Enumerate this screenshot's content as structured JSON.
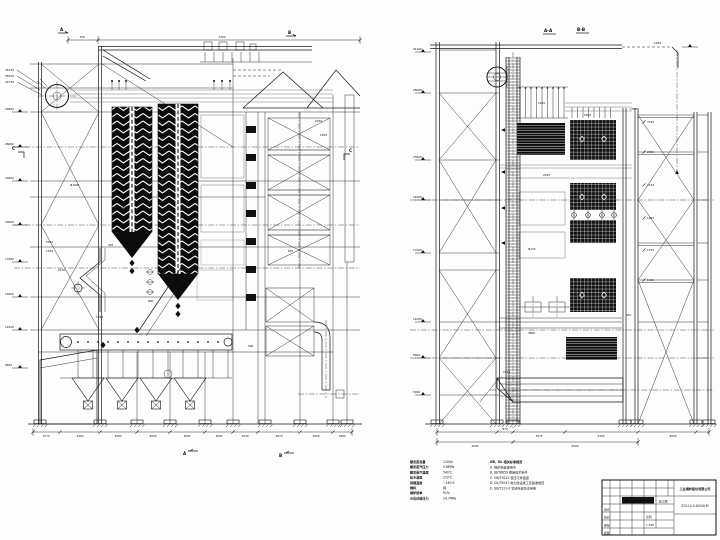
{
  "left_view": {
    "section_a": "A",
    "section_b": "B",
    "section_c_left": "C",
    "section_c_right": "C",
    "bottom_section_a": "A",
    "bottom_section_b": "B",
    "top_dims": [
      "750",
      "7200"
    ],
    "drum_callouts": [
      "36330",
      "35500",
      "34730"
    ],
    "left_elevations": [
      "29600",
      "26600",
      "23600",
      "20600",
      "17600",
      "14600",
      "11600",
      "8600"
    ],
    "bottom_dims": [
      "1570",
      "2400",
      "3000",
      "3000",
      "3000",
      "3000",
      "2540",
      "3070",
      "3000",
      "1800"
    ],
    "inner_dims": [
      "345",
      "2640",
      "1430",
      "16-Φ426",
      "Φ1600",
      "2740",
      "1959",
      "800",
      "2430",
      "1250",
      "500",
      "645"
    ]
  },
  "right_view": {
    "label_aa": "A-A",
    "label_bb": "B-B",
    "top_dim": "1959",
    "left_elevations": [
      "31100",
      "28000",
      "23600",
      "21000",
      "17000",
      "11000",
      "8000",
      "5000"
    ],
    "right_dims": [
      "7150",
      "2450",
      "2143",
      "1950",
      "1750",
      "1310"
    ],
    "bottom_dims_upper": [
      "870",
      "3075",
      "5300",
      "4000"
    ],
    "bottom_dims_lower": [
      "4500",
      "5000"
    ],
    "inner_dims": [
      "1250",
      "2420",
      "Φ133",
      "2500",
      "3600",
      "970",
      "2130",
      "1350"
    ]
  },
  "notes": {
    "specs": [
      {
        "label": "额定蒸发量",
        "value": "110t/h"
      },
      {
        "label": "额定蒸汽压力",
        "value": "9.8MPa"
      },
      {
        "label": "额定蒸汽温度",
        "value": "540℃"
      },
      {
        "label": "给水温度",
        "value": "210℃"
      },
      {
        "label": "排烟温度",
        "value": "~140℃"
      },
      {
        "label": "燃料",
        "value": "煤"
      },
      {
        "label": "锅炉效率",
        "value": "91%"
      },
      {
        "label": "水压试验压力",
        "value": "14.7MPa"
      }
    ],
    "standards_header": "GB、DL 相关标准规范",
    "standards": [
      "A. 锅炉安装说明书",
      "B. JB/T8659 焊接技术条件",
      "C. GB/T9222 受压元件强度",
      "D. DL/T5047 电力建设施工及验收规范",
      "E. GB/T121-0 管道布置及支吊架"
    ]
  },
  "title_block": {
    "company": "工业锅炉股份有限公司",
    "drawing_no": "ZG110-9.8/540-M",
    "title": "锅炉总图",
    "stage": "施工图",
    "scale_label": "比例",
    "scale": "1:100",
    "sig_labels": [
      "设计",
      "校对",
      "审核",
      "批准"
    ]
  }
}
